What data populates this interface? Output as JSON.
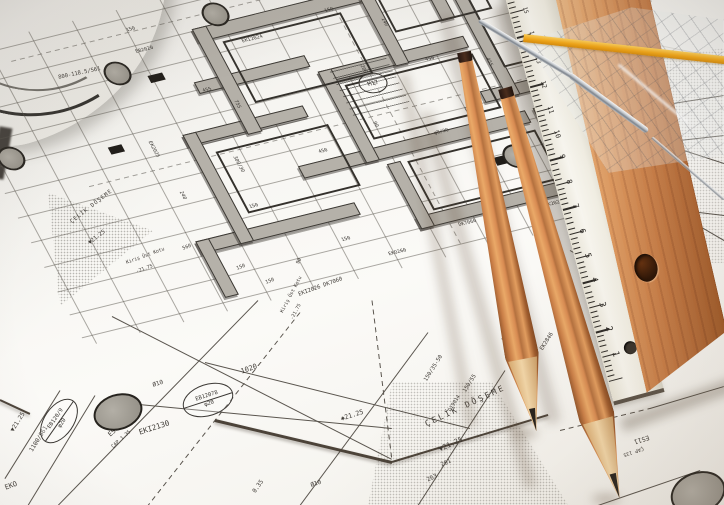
{
  "photo": {
    "subject": "architectural blueprint floor plan with drafting tools",
    "colors": {
      "paper": "#f7f6f2",
      "plan_wall_gray": "#b5b1a9",
      "ink": "#3e3a35",
      "plank_wood": "#c87f49",
      "pencil_wood": "#d88b52",
      "set_square_stripe": "#f4a714"
    },
    "annotations": [
      {
        "text": "ÇELİK DÖŞEME",
        "x": 424,
        "y": 421,
        "r": -25,
        "fs": 8,
        "ls": 2.5
      },
      {
        "text": "▼21.25",
        "x": 438,
        "y": 447,
        "r": -25,
        "fs": 7
      },
      {
        "text": "261",
        "x": 440,
        "y": 463,
        "r": -25,
        "fs": 6
      },
      {
        "text": "263",
        "x": 426,
        "y": 478,
        "r": -25,
        "fs": 6
      },
      {
        "text": "ÇELİK DÖŞEME",
        "x": 70,
        "y": 221,
        "r": -38,
        "fs": 5.5,
        "ls": 1
      },
      {
        "text": "▼21.25",
        "x": 88,
        "y": 242,
        "r": -38,
        "fs": 5.5
      },
      {
        "text": "1020",
        "x": 240,
        "y": 369,
        "r": -20,
        "fs": 7
      },
      {
        "text": "EKI2130",
        "x": 138,
        "y": 429,
        "r": -18,
        "fs": 7.5
      },
      {
        "text": "ES14",
        "x": 107,
        "y": 433,
        "r": -42,
        "fs": 6.5
      },
      {
        "text": "ÇAP 1.35",
        "x": 111,
        "y": 446,
        "r": -42,
        "fs": 5
      },
      {
        "text": "1100/561",
        "x": 29,
        "y": 450,
        "r": -58,
        "fs": 6
      },
      {
        "text": "▼21.25",
        "x": 10,
        "y": 430,
        "r": -58,
        "fs": 6
      },
      {
        "text": "EKO",
        "x": 4,
        "y": 485,
        "r": -20,
        "fs": 7
      },
      {
        "text": "✱21.25",
        "x": 340,
        "y": 416,
        "r": -18,
        "fs": 6.5
      },
      {
        "text": "0.35",
        "x": 252,
        "y": 491,
        "r": -55,
        "fs": 6
      },
      {
        "text": "Ø10",
        "x": 152,
        "y": 383,
        "r": -18,
        "fs": 6
      },
      {
        "text": "Ø10",
        "x": 310,
        "y": 483,
        "r": -18,
        "fs": 6
      },
      {
        "text": "ES11",
        "x": 650,
        "y": 440,
        "r": 162,
        "fs": 6.5
      },
      {
        "text": "ÇAP 135",
        "x": 644,
        "y": 450,
        "r": 162,
        "fs": 5
      },
      {
        "text": "150/35-50",
        "x": 424,
        "y": 380,
        "r": -58,
        "fs": 5.5
      },
      {
        "text": "150/55",
        "x": 463,
        "y": 391,
        "r": -58,
        "fs": 5.5
      },
      {
        "text": "D19014",
        "x": 448,
        "y": 410,
        "r": -58,
        "fs": 5
      },
      {
        "text": "Kiriş Üst Kotu",
        "x": 126,
        "y": 262,
        "r": -20,
        "fs": 4.8
      },
      {
        "text": "-21.75",
        "x": 136,
        "y": 271,
        "r": -20,
        "fs": 4.8
      },
      {
        "text": "Kiriş Üst Kotu",
        "x": 281,
        "y": 312,
        "r": -62,
        "fs": 4.8
      },
      {
        "text": "-21.75",
        "x": 291,
        "y": 319,
        "r": -62,
        "fs": 4.8
      },
      {
        "text": "560",
        "x": 182,
        "y": 247,
        "r": -20,
        "fs": 5
      },
      {
        "text": "150",
        "x": 236,
        "y": 267,
        "r": -20,
        "fs": 5
      },
      {
        "text": "150",
        "x": 265,
        "y": 281,
        "r": -20,
        "fs": 5
      },
      {
        "text": "90",
        "x": 296,
        "y": 263,
        "r": -62,
        "fs": 5
      },
      {
        "text": "EKI2026 DK7060",
        "x": 298,
        "y": 293,
        "r": -20,
        "fs": 5.5
      },
      {
        "text": "800-118.5/561",
        "x": 58,
        "y": 76,
        "r": -12,
        "fs": 5.5
      },
      {
        "text": "EK2846",
        "x": 540,
        "y": 349,
        "r": -58,
        "fs": 5.5
      },
      {
        "text": "EB2028",
        "x": 502,
        "y": 340,
        "r": -58,
        "fs": 5.5
      }
    ],
    "circled_labels": [
      {
        "top": "EB12078",
        "bottom": "φ20",
        "x": 182,
        "y": 384,
        "r": -18,
        "w": 50,
        "h": 30
      },
      {
        "top": "EB120/9",
        "bottom": "φ20",
        "x": 34,
        "y": 406,
        "r": -55,
        "w": 48,
        "h": 28
      }
    ],
    "plan_circled_label": {
      "text": "M17",
      "u": 258,
      "v": 56,
      "w": 26,
      "h": 20
    },
    "plan_labels": [
      {
        "text": "450",
        "u": 176,
        "v": 110,
        "r": 0
      },
      {
        "text": "150",
        "u": 86,
        "v": 148,
        "r": 0
      },
      {
        "text": "755",
        "u": 128,
        "v": 40,
        "r": 90
      },
      {
        "text": "140",
        "u": 302,
        "v": -6,
        "r": 90
      },
      {
        "text": "7060",
        "u": 322,
        "v": 132,
        "r": 0
      },
      {
        "text": "DK7060",
        "u": 268,
        "v": 218,
        "r": 0
      },
      {
        "text": "EK2023",
        "u": 356,
        "v": 220,
        "r": 0
      },
      {
        "text": "EK2027",
        "u": 420,
        "v": -36,
        "r": 90
      },
      {
        "text": "EB2020",
        "u": 58,
        "v": -36,
        "r": 0
      },
      {
        "text": "φ10",
        "u": 396,
        "v": 204,
        "r": 0
      },
      {
        "text": "90",
        "u": 244,
        "v": 96,
        "r": 90
      },
      {
        "text": "180",
        "u": 210,
        "v": -56,
        "r": 0
      },
      {
        "text": "240",
        "u": 34,
        "v": 118,
        "r": 90
      },
      {
        "text": "450",
        "u": 318,
        "v": 44,
        "r": 0
      },
      {
        "text": "150",
        "u": 154,
        "v": 204,
        "r": 0
      },
      {
        "text": "455",
        "u": 100,
        "v": 20,
        "r": 0
      },
      {
        "text": "EKI2024",
        "u": 160,
        "v": -20,
        "r": 0
      },
      {
        "text": "DK7060",
        "u": 330,
        "v": 104,
        "r": 0
      },
      {
        "text": "φ8/20",
        "u": 290,
        "v": 120,
        "r": 0
      },
      {
        "text": "455",
        "u": 378,
        "v": 60,
        "r": 90
      },
      {
        "text": "EB2027",
        "u": 448,
        "v": 120,
        "r": 90
      },
      {
        "text": "150",
        "u": 250,
        "v": -30,
        "r": 0
      },
      {
        "text": "EKO260",
        "u": 190,
        "v": 230,
        "r": 0
      },
      {
        "text": "150",
        "u": 60,
        "v": -60,
        "r": 0
      },
      {
        "text": "300/30",
        "u": 100,
        "v": 96,
        "r": 90
      },
      {
        "text": "EB2024",
        "u": 420,
        "v": 80,
        "r": 0
      },
      {
        "text": "200",
        "u": 260,
        "v": 36,
        "r": 90
      },
      {
        "text": "EK2025",
        "u": 30,
        "v": 60,
        "r": 90
      }
    ],
    "white_ruler_numbers": [
      "1",
      "2",
      "3",
      "4",
      "5",
      "6",
      "7",
      "8",
      "9",
      "10",
      "11",
      "12",
      "13",
      "14",
      "15"
    ]
  }
}
